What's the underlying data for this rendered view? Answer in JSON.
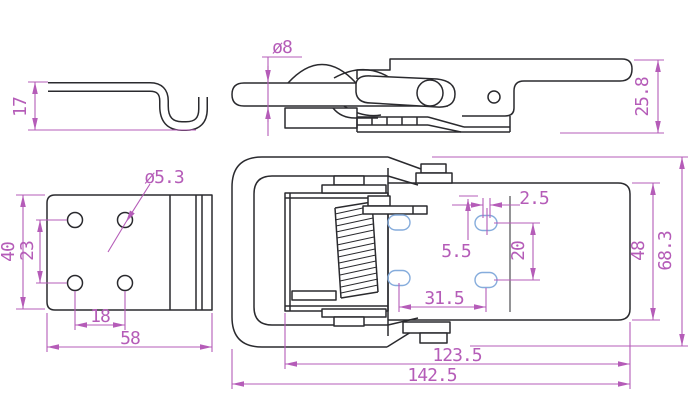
{
  "drawing": {
    "title": "toggle-latch-technical-drawing",
    "colors": {
      "outline": "#2a2a2e",
      "dimension": "#b55cb8",
      "slot_highlight": "#85acdc",
      "background": "#ffffff"
    }
  },
  "views": {
    "hook_side": {
      "label": "hook-plate-side-view",
      "dims": {
        "height": "17"
      }
    },
    "latch_side": {
      "label": "latch-side-view",
      "dims": {
        "rod_diameter": "ø8",
        "height": "25.8"
      }
    },
    "mounting_plate": {
      "label": "hook-plate-top-view",
      "dims": {
        "hole_diameter": "ø5.3",
        "plate_height": "40",
        "hole_pitch_v": "23",
        "hole_pitch_h": "18",
        "plate_width": "58"
      }
    },
    "latch_top": {
      "label": "latch-top-view",
      "dims": {
        "slot_offset": "2.5",
        "slot_width": "5.5",
        "slot_pitch_v": "20",
        "slot_pitch_h": "31.5",
        "body_width": "48",
        "overall_width": "68.3",
        "body_length": "123.5",
        "overall_length": "142.5"
      }
    }
  }
}
